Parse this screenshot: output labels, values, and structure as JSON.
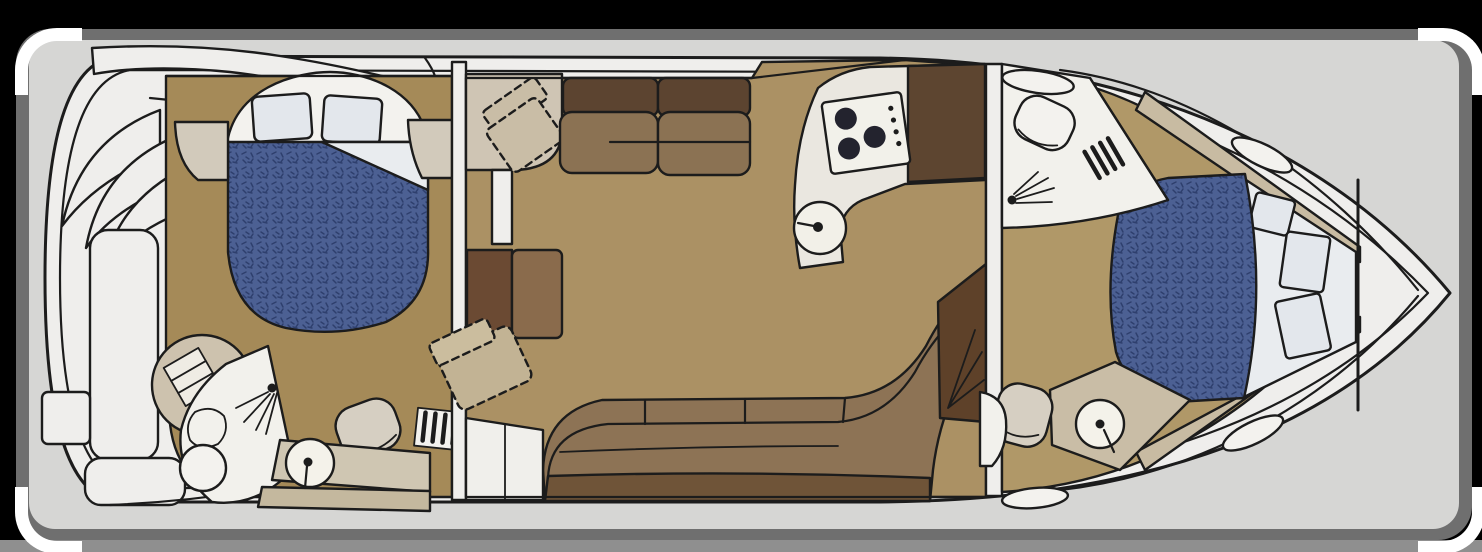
{
  "image": {
    "type": "boat-floorplan-illustration",
    "description": "Top-down interior floor plan of a motor yacht, bow to the right, stern to the left",
    "orientation": {
      "bow": "right",
      "stern": "left"
    }
  },
  "frame": {
    "background": "#000000",
    "mat": "#6f6f6f",
    "canvas": "#d6d6d4",
    "bottom_strip": "#8f8f8f",
    "corner_marks": "#ffffff"
  },
  "palette": {
    "line": "#1c1c1c",
    "deck_white": "#efeeec",
    "fixture_white": "#f3f2ee",
    "carpet_aft": "#a58a58",
    "carpet_salon": "#ab9164",
    "carpet_forward": "#b09868",
    "galley_floor": "#b29565",
    "mattress_blue": "#4c6093",
    "mattress_texture": "#2e3f6d",
    "bedding_white": "#e9ecef",
    "pillow": "#e3e7ec",
    "nightstand_beige": "#d2cabb",
    "platform_beige": "#cfc5b4",
    "chair_beige": "#c9bda6",
    "sofa_back": "#5c4430",
    "sofa_seat": "#8b7253",
    "settee_seat": "#8d7355",
    "settee_back": "#6f5438",
    "cabinet_dark": "#6b4a33",
    "cabinet_mid": "#8a6b4c",
    "corner_cabinet": "#5e4129",
    "counter_white": "#eae7e0",
    "counter_beige": "#cfc6b2",
    "counter_dark": "#5d4530",
    "vanity_beige": "#c9bda6",
    "fixture_beige": "#d6cfc2",
    "shower_disc": "#cdc2ae",
    "stove_burner": "#23232e",
    "liner_trim": "#c8bba2"
  },
  "rooms": [
    {
      "name": "cockpit-stern",
      "features": [
        "bench-seat",
        "transom-step-fans",
        "engine-hatch",
        "swim-step",
        "aft-bench"
      ]
    },
    {
      "name": "aft-stateroom",
      "features": [
        "island-berth",
        "two-pillows",
        "turned-sheet",
        "nightstand-port",
        "nightstand-starboard",
        "entry-steps"
      ]
    },
    {
      "name": "aft-head",
      "features": [
        "shower-stall",
        "shower-spray",
        "toilet",
        "vanity-sink",
        "drain-circle",
        "towel-shelf"
      ]
    },
    {
      "name": "salon",
      "features": [
        "dashed-armchair",
        "corner-platform",
        "doorway",
        "sofa-two-section",
        "dresser-cabinet",
        "wraparound-settee",
        "dashed-ottoman",
        "corner-cabinet"
      ]
    },
    {
      "name": "galley",
      "features": [
        "angled-counter",
        "three-burner-cooktop",
        "control-knobs",
        "round-sink-with-faucet"
      ]
    },
    {
      "name": "forward-head",
      "features": [
        "oval-sink",
        "toilet",
        "shower-spray",
        "entry-steps"
      ]
    },
    {
      "name": "forward-stateroom",
      "features": [
        "angled-island-berth",
        "three-pillows",
        "vanity-sink",
        "seat",
        "chain-locker-bulkhead"
      ]
    },
    {
      "name": "foredeck",
      "features": [
        "deck-hatch-top",
        "deck-hatch-bottom",
        "deck-hatch-aft-bottom",
        "bow-pulpit-lines"
      ]
    }
  ]
}
